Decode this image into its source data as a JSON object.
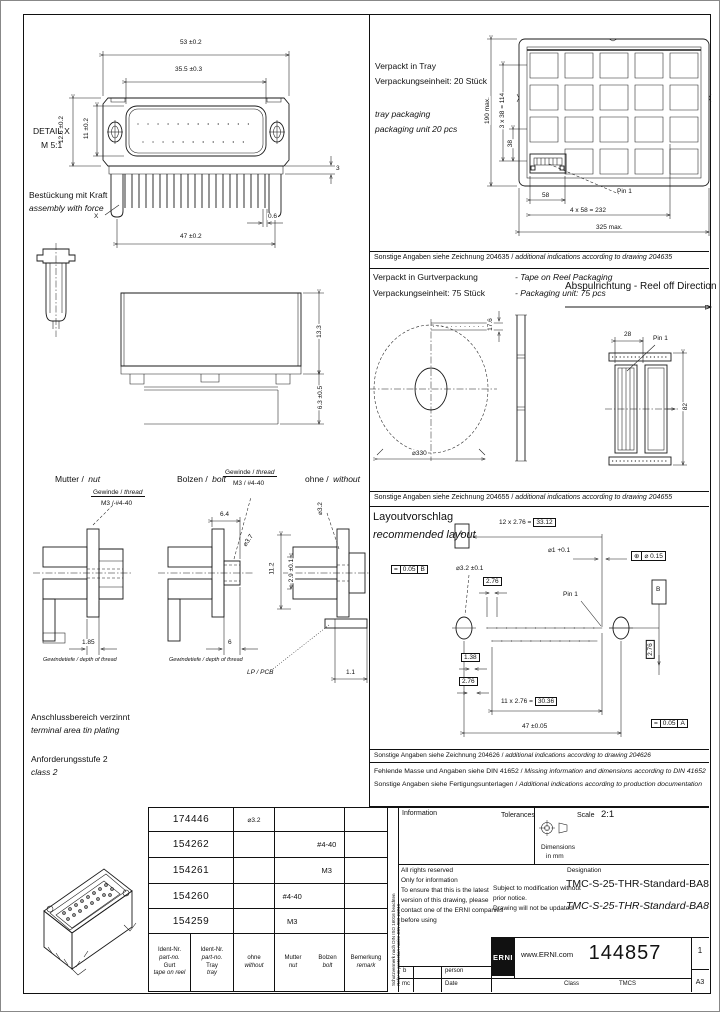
{
  "front_view": {
    "detail_label": "DETAIL X",
    "detail_scale": "M 5:1",
    "assembly_note_de": "Bestückung mit Kraft",
    "assembly_note_en": "assembly with force",
    "x_ref": "X",
    "dim_flange_width": "53 ±0.2",
    "dim_shroud_width": "35.5 ±0.3",
    "dim_flange_height": "12.6 ±0.2",
    "dim_shroud_height": "11 ±0.2",
    "dim_pin_len": "3",
    "dim_pin_width": "0.6",
    "dim_hole_pitch": "47 ±0.2"
  },
  "side_view": {
    "dim_height": "13.3",
    "dim_pin_proj": "6.3 ±0.5"
  },
  "variants": {
    "nut": {
      "label_de": "Mutter /",
      "label_en": "nut",
      "thread_de": "Gewinde /",
      "thread_en": "thread",
      "thread_size": "M3 / #4-40",
      "depth_dim": "1.85",
      "depth_label": "Gewindetiefe / depth of thread"
    },
    "bolt": {
      "label_de": "Bolzen /",
      "label_en": "bolt",
      "thread_de": "Gewinde /",
      "thread_en": "thread",
      "thread_size": "M3 / #4-40",
      "length_dim": "6.4",
      "dia_dim": "⌀3.7",
      "depth_dim": "6",
      "depth_label": "Gewindetiefe / depth of thread"
    },
    "without": {
      "label_de": "ohne /",
      "label_en": "without",
      "dia_dim": "⌀3.2",
      "dim_height": "11.2",
      "dim_offset": "2.9 ±0.1",
      "pcb_label": "LP / PCB",
      "dim_board": "1.1"
    }
  },
  "notes_left": {
    "plating_de": "Anschlussbereich verzinnt",
    "plating_en": "terminal area tin plating",
    "class_de": "Anforderungsstufe 2",
    "class_en": "class 2"
  },
  "tray": {
    "line1_de": "Verpackt in Tray",
    "line2_de": "Verpackungseinheit: 20 Stück",
    "line1_en": "tray packaging",
    "line2_en": "packaging unit 20 pcs",
    "pin1": "Pin 1",
    "dim_pitch": "58",
    "dim_span": "4 x 58 = 232",
    "dim_width": "325 max.",
    "dim_height": "190 max.",
    "dim_rows": "3 x 38 = 114",
    "dim_row_pitch": "38",
    "note_de": "Sonstige Angaben siehe Zeichnung 204635 /",
    "note_en": "additional indications according to drawing 204635"
  },
  "reel": {
    "line1_de": "Verpackt in Gurtverpackung",
    "line1_en": "- Tape on Reel Packaging",
    "line2_de": "Verpackungseinheit: 75 Stück",
    "line2_en": "- Packaging unit: 75 pcs",
    "direction": "Abspulrichtung - Reel off Direction",
    "dia": "⌀330",
    "dim_tape": "17.6",
    "dim_pocket": "28",
    "pin1": "Pin 1",
    "dim_tape_width": "82",
    "note_de": "Sonstige Angaben siehe Zeichnung 204655 /",
    "note_en": "additional indications according to drawing 204655"
  },
  "layout": {
    "title_de": "Layoutvorschlag",
    "title_en": "recommended layout",
    "datum_a": "A",
    "datum_b": "B",
    "dim_top_prefix": "12 x 2.76 =",
    "dim_top_sum": "33.12",
    "hole_dia": "⌀1 +0.1",
    "pos_sym": "⊕",
    "pos_tol": "⌀ 0.15",
    "par_sym": "=",
    "par_tol_b": "0.05",
    "par_ref_b": "B",
    "mount_dia": "⌀3.2 ±0.1",
    "pitch_dim": "2.76",
    "half_pitch_dim": "1.38",
    "pitch_dim2": "2.76",
    "row_offset_dim": "2.76",
    "pin1": "Pin 1",
    "dim_bottom_prefix": "11 x 2.76 =",
    "dim_bottom_sum": "30.36",
    "dim_hole_span": "47 ±0.05",
    "par_tol_a": "0.05",
    "par_ref_a": "A",
    "note_de": "Sonstige Angaben siehe Zeichnung 204626 /",
    "note_en": "additional indications according to drawing 204626"
  },
  "right_notes": {
    "din_de": "Fehlende Masse und Angaben siehe DIN 41652 /",
    "din_en": "Missing information and dimensions according to DIN 41652",
    "prod_de": "Sonstige Angaben siehe Fertigungsunterlagen /",
    "prod_en": "Additional indications according to production documentation"
  },
  "parts_table": {
    "headers": {
      "c1": [
        "Ident-Nr.",
        "part-no.",
        "Gurt",
        "tape on reel"
      ],
      "c2": [
        "Ident-Nr.",
        "part-no.",
        "Tray",
        "tray"
      ],
      "c3": [
        "ohne",
        "without"
      ],
      "c4": [
        "Mutter",
        "nut"
      ],
      "c5": [
        "Bolzen",
        "bolt"
      ],
      "c6": [
        "Bemerkung",
        "remark"
      ]
    },
    "rows": [
      {
        "pn": "174446",
        "ohne": "⌀3.2",
        "mutter": "",
        "bolzen": "",
        "remark": ""
      },
      {
        "pn": "154262",
        "ohne": "",
        "mutter": "",
        "bolzen": "#4-40",
        "remark": ""
      },
      {
        "pn": "154261",
        "ohne": "",
        "mutter": "",
        "bolzen": "M3",
        "remark": ""
      },
      {
        "pn": "154260",
        "ohne": "",
        "mutter": "#4-40",
        "bolzen": "",
        "remark": ""
      },
      {
        "pn": "154259",
        "ohne": "",
        "mutter": "M3",
        "bolzen": "",
        "remark": ""
      }
    ]
  },
  "title_block": {
    "info_label": "Information",
    "tolerances_label": "Tolerances",
    "scale_label": "Scale",
    "scale_value": "2:1",
    "dims_line1": "Dimensions",
    "dims_line2": "in mm",
    "rights": [
      "All rights reserved",
      "Only for information",
      "To ensure that this is the latest",
      "version of this drawing, please",
      "contact one of the ERNI companies",
      "before using"
    ],
    "modification": [
      "Subject to modification without",
      "prior notice.",
      "Drawing will not be updated."
    ],
    "designation_label": "Designation",
    "designation": "TMC-S-25-THR-Standard-BA8",
    "designation_alt": "TMC-S-25-THR-Standard-BA8",
    "logo_text": "ERNI",
    "website": "www.ERNI.com",
    "doc_number": "144857",
    "sheet_no": "1",
    "format": "A3",
    "footer": {
      "r1c1": "b",
      "r1c2": "person",
      "r2c1": "mc",
      "r2c2": "Date",
      "r2c3": "Class",
      "r2c4": "TMCS"
    },
    "protection_de": "Schutzvermerk nach DIN ISO 16016 beachten",
    "protection_en": "Refer to protection notice DIN ISO 16016"
  }
}
